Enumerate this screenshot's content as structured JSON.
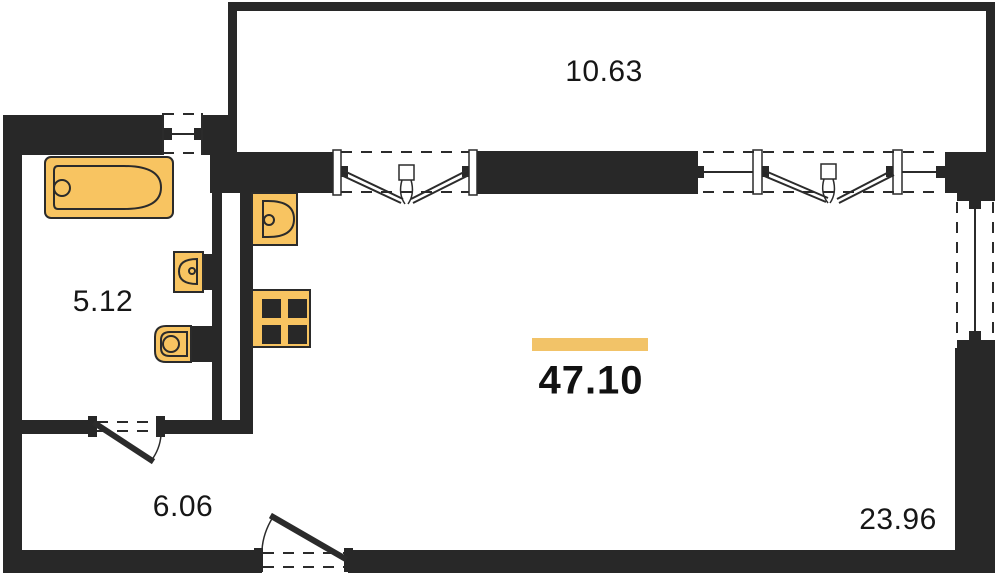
{
  "plan": {
    "type": "apartment-floor-plan",
    "areas": {
      "balcony": "10.63",
      "bathroom": "5.12",
      "hallway": "6.06",
      "room": "23.96",
      "total": "47.10"
    },
    "fixtures": [
      "bathtub",
      "wash-basin",
      "toilet",
      "kitchen-sink",
      "stove-4-burner"
    ],
    "colors": {
      "wall": "#282828",
      "fixture": "#F8C461",
      "fixture_outline": "#2B2B2B",
      "accent_bar": "#F2C368",
      "line": "#2B2B2B",
      "background": "#FFFFFF"
    }
  }
}
